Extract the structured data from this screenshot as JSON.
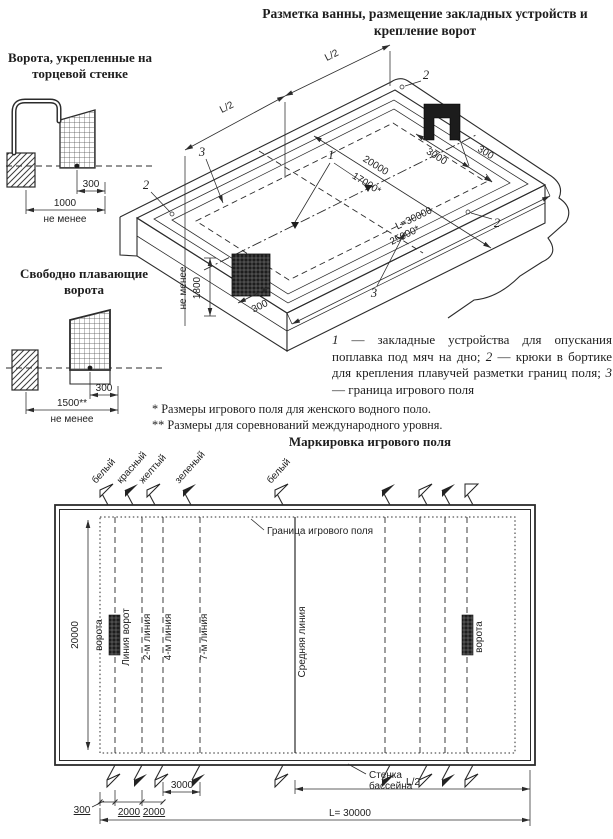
{
  "page": {
    "title": "Разметка ванны, размещение закладных устройств и крепление ворот"
  },
  "wall_goal": {
    "title": "Ворота, укрепленные на торцевой стенке",
    "dim_offset": "300",
    "dim_width": "1000",
    "dim_note": "не менее"
  },
  "floating_goal": {
    "title": "Свободно плавающие ворота",
    "dim_offset": "300",
    "dim_width": "1500**",
    "dim_note": "не менее"
  },
  "iso": {
    "dim_l2_left": "L/2",
    "dim_l2_right": "L/2",
    "dim_width_main": "20000",
    "dim_width_alt": "17000*",
    "dim_goal_width": "3000",
    "dim_goal_offset": "300",
    "dim_goal_offset_left": "300",
    "dim_length_main": "L=30000",
    "dim_length_alt": "25000*",
    "dim_depth": "1800",
    "dim_depth_note": "не менее",
    "callout_anchor": "1",
    "callout_hook": "2",
    "callout_boundary": "3"
  },
  "legend": {
    "n1": "1",
    "t1": " — закладные устройства для опускания поплавка под мяч на дно; ",
    "n2": "2",
    "t2": " — крюки в бортике для крепления плавучей разметки границ поля; ",
    "n3": "3",
    "t3": " — граница игрового поля"
  },
  "footnotes": {
    "line1": "* Размеры игрового поля для женского водного поло.",
    "line2": "** Размеры для соревнований международного уровня."
  },
  "field": {
    "title": "Маркировка игрового поля",
    "flags": {
      "white": "белый",
      "red": "красный",
      "yellow": "желтый",
      "green": "зеленый",
      "white_mid": "белый"
    },
    "boundary_label": "Граница игрового поля",
    "goal_label_left": "ворота",
    "goal_label_right": "ворота",
    "goal_line_label": "Линия ворот",
    "line_2m": "2-м линия",
    "line_4m": "4-м линия",
    "line_7m": "7-м линия",
    "center_line_label": "Средняя линия",
    "wall_label_line1": "Стенка",
    "wall_label_line2": "бассейна",
    "dim_width": "20000",
    "dim_offset": "300",
    "dim_2m": "2000",
    "dim_4m": "2000",
    "dim_7m": "3000",
    "dim_half": "L/2",
    "dim_length": "L= 30000"
  }
}
